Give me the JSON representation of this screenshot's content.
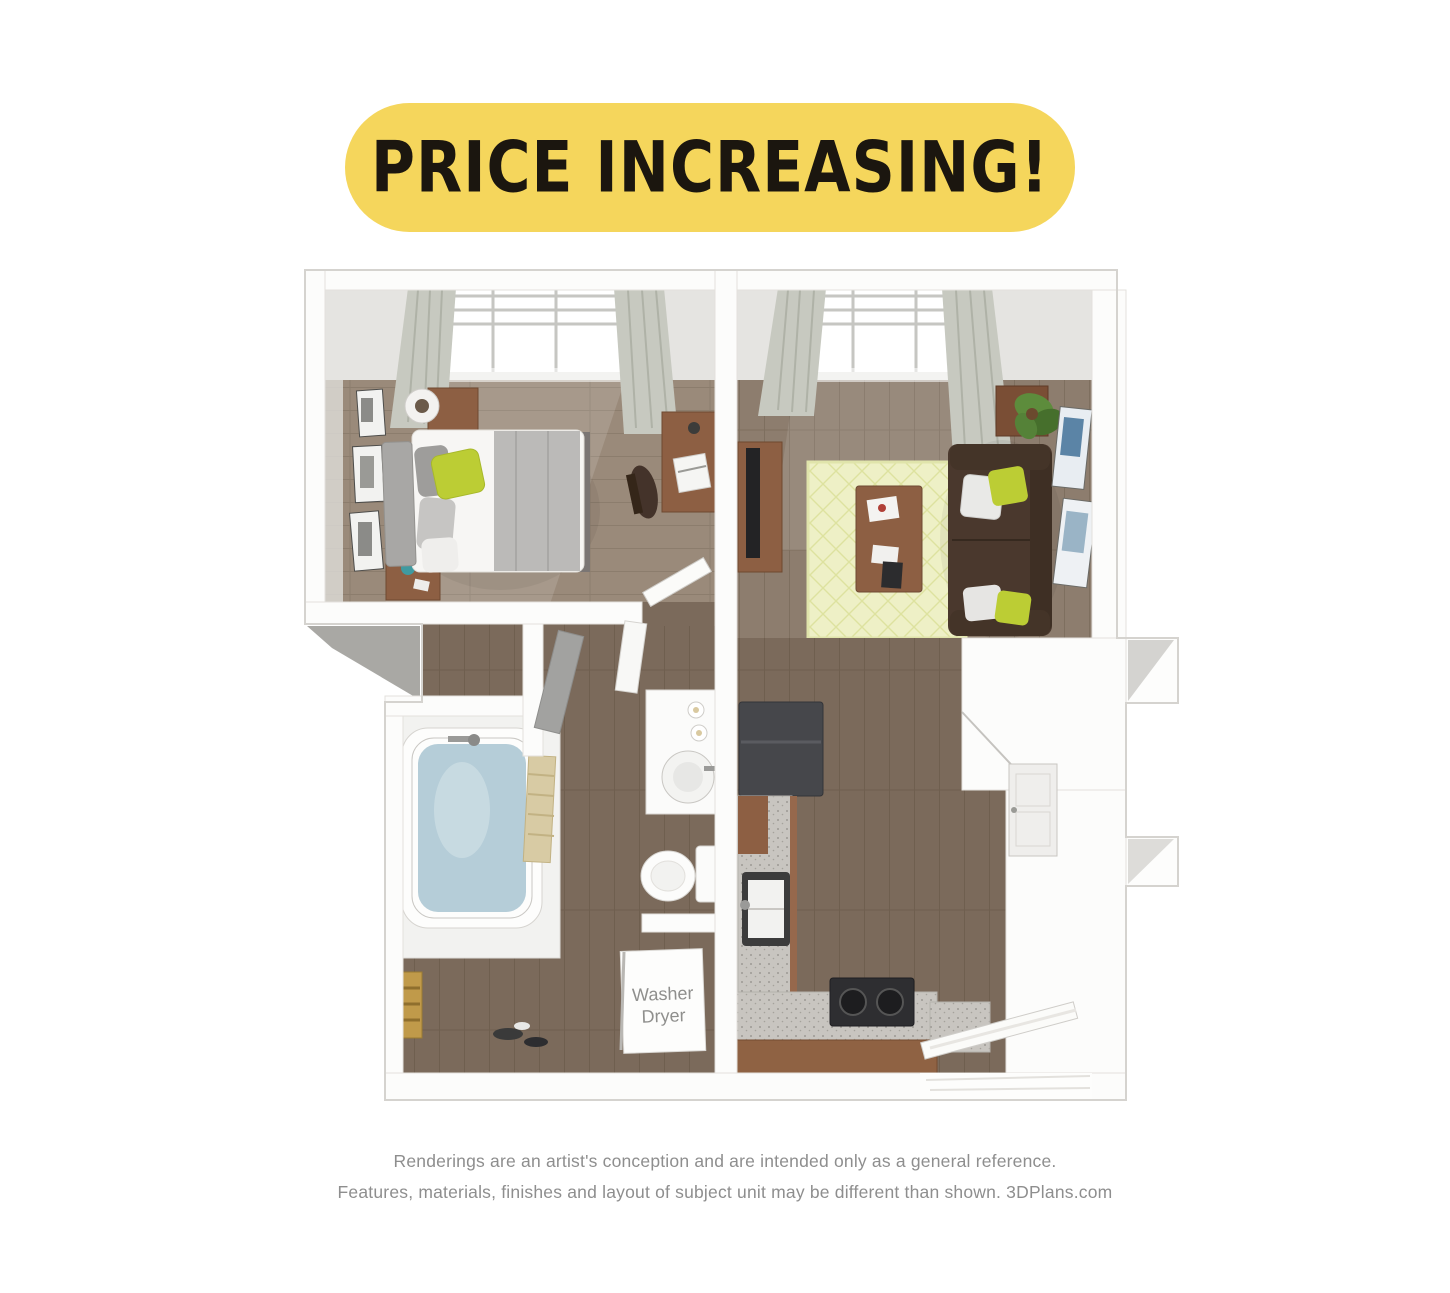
{
  "banner": {
    "text": "PRICE INCREASING!"
  },
  "floor_plan": {
    "washer_dryer_label": {
      "line1": "Washer",
      "line2": "Dryer"
    }
  },
  "disclaimer": {
    "line1": "Renderings are an artist's conception and are intended only as a general reference.",
    "line2": "Features, materials, finishes and layout of subject unit may be different than shown. 3DPlans.com"
  },
  "colors": {
    "banner_bg": "#F5D65C",
    "banner_text": "#1B160F",
    "wall_white": "#FCFCFB",
    "wall_face_gray": "#E5E4E1",
    "floor_wood_light": "#9A8A7A",
    "floor_wood_mid": "#8D7D6E",
    "floor_wood_dark": "#7B6A5B",
    "rug_green": "#EEF0C6",
    "accent_green_pillow": "#BCCD34",
    "sofa_brown": "#4A382D",
    "furniture_wood": "#8D5F43",
    "tub_water_blue": "#B5CDD8",
    "granite_counter": "#C8C5C0",
    "fridge_charcoal": "#46474B",
    "towel_tan": "#D8CBA4",
    "disclaimer_text": "#8E8E8E"
  }
}
